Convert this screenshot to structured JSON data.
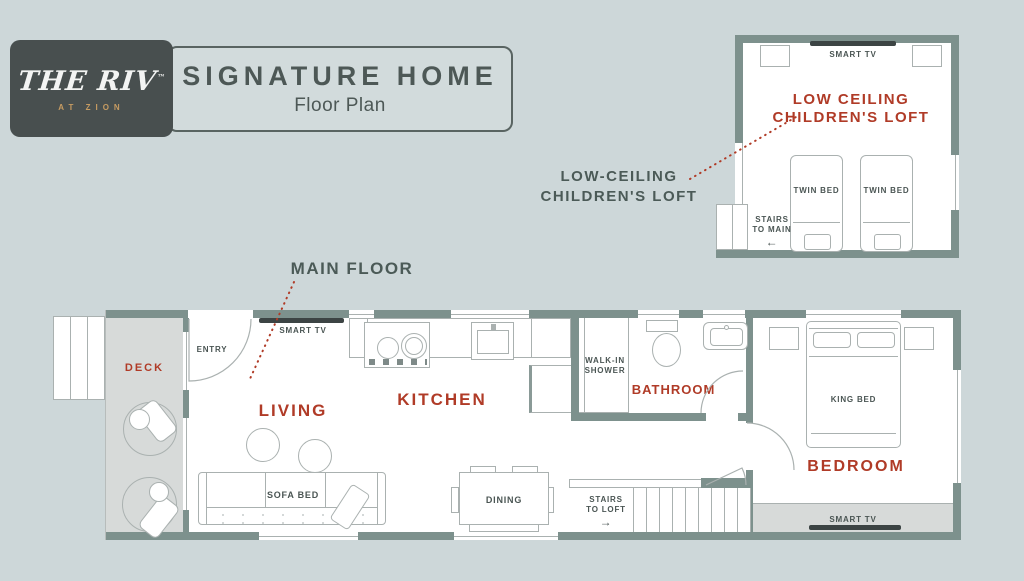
{
  "colors": {
    "background": "#cdd7d9",
    "wall": "#7d918d",
    "accent_red": "#b03b27",
    "text_dark": "#4a5553",
    "logo_bg": "#484f4f",
    "gold": "#c79c62",
    "deck_gray": "#d7dad9",
    "line_gray": "#aab1b0",
    "tv_dark": "#3c4444"
  },
  "logo": {
    "brand": "THE RIV",
    "trademark": "™",
    "subtitle": "AT ZION"
  },
  "title_card": {
    "title": "SIGNATURE HOME",
    "subtitle": "Floor Plan"
  },
  "callouts": {
    "main_floor": "MAIN FLOOR",
    "loft_line1": "LOW-CEILING",
    "loft_line2": "CHILDREN'S LOFT"
  },
  "loft": {
    "smart_tv": "SMART TV",
    "label_line1": "LOW CEILING",
    "label_line2": "CHILDREN'S LOFT",
    "twin_bed_left": "TWIN BED",
    "twin_bed_right": "TWIN BED",
    "stairs_line1": "STAIRS",
    "stairs_line2": "TO MAIN",
    "stairs_arrow": "←"
  },
  "main_floor": {
    "deck": "DECK",
    "entry": "ENTRY",
    "living_smart_tv": "SMART TV",
    "living": "LIVING",
    "kitchen": "KITCHEN",
    "sofa_bed": "SOFA BED",
    "dining": "DINING",
    "shower_line1": "WALK-IN",
    "shower_line2": "SHOWER",
    "bathroom": "BATHROOM",
    "stairs_line1": "STAIRS",
    "stairs_line2": "TO LOFT",
    "stairs_arrow": "→",
    "king_bed": "KING BED",
    "bedroom": "BEDROOM",
    "bedroom_smart_tv": "SMART TV"
  }
}
